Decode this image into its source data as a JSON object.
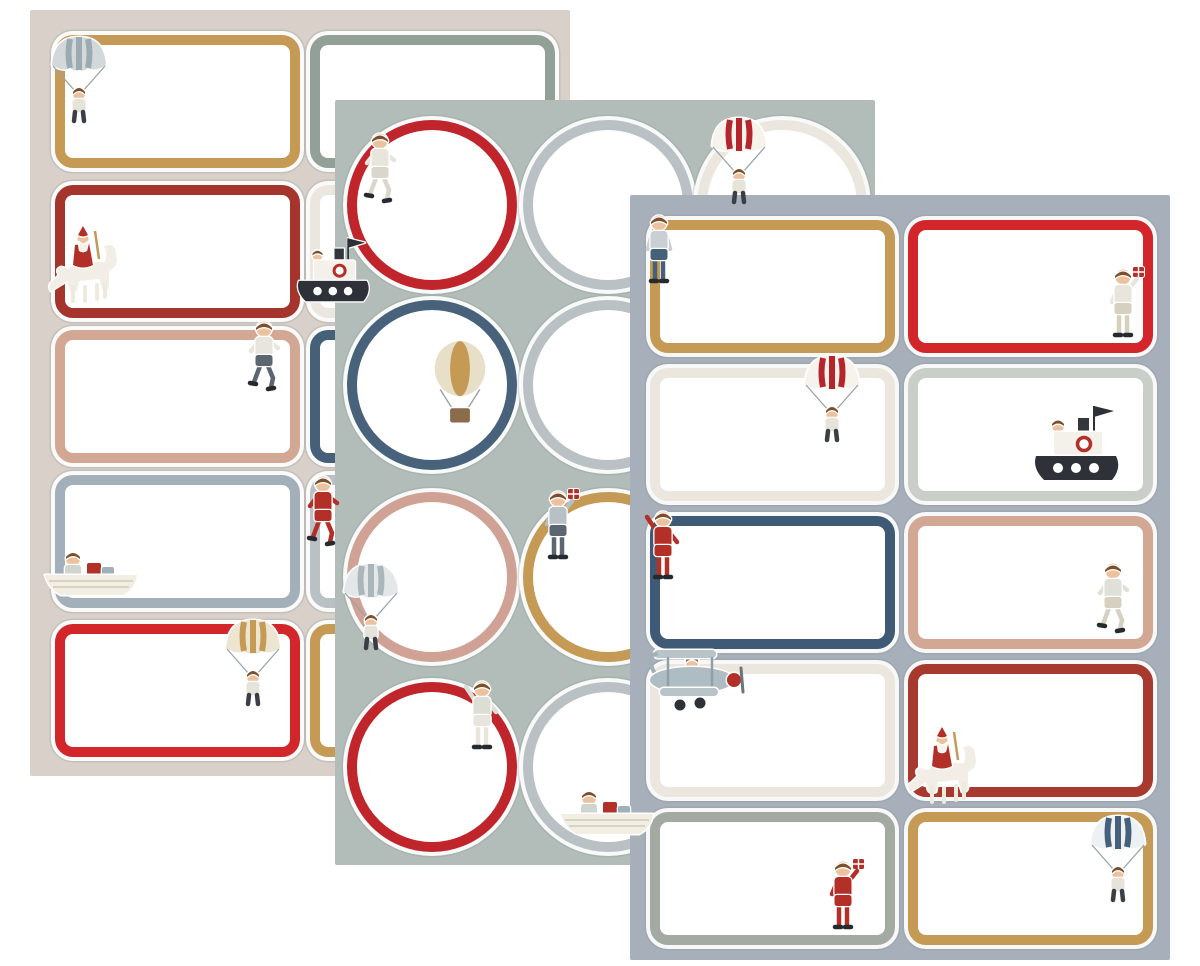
{
  "scene": {
    "background": "#ffffff",
    "palette": {
      "gold": "#c49a55",
      "bright_red": "#d2262b",
      "dark_red": "#a4342c",
      "dusty_pink": "#d2a794",
      "navy": "#46607a",
      "blue_grey": "#a3b0b9",
      "light_grey": "#bac1c4",
      "ivory": "#ece7de",
      "sage": "#93a098"
    }
  },
  "sheets": [
    {
      "id": "left",
      "bg": "#d8d0c9",
      "x": 30,
      "y": 10,
      "w": 540,
      "h": 766,
      "shape": "rect",
      "cell": {
        "w": 245,
        "h": 133
      },
      "col_x": [
        25,
        280
      ],
      "row_y": [
        25,
        175,
        320,
        465,
        614
      ],
      "labels": [
        {
          "row": 0,
          "col": 0,
          "border": "#c49a55",
          "icon": {
            "type": "parachute",
            "canopy": "#d3d9da",
            "stripe": "#9cabb2"
          },
          "ix": -8,
          "iy": -4
        },
        {
          "row": 1,
          "col": 0,
          "border": "#a4342c",
          "icon": {
            "type": "santa"
          },
          "ix": -10,
          "iy": 44
        },
        {
          "row": 2,
          "col": 0,
          "border": "#d2a794",
          "icon": {
            "type": "boy",
            "pose": "run",
            "shirt": "#e8e5dc",
            "pants": "#5b6670"
          },
          "ix": 186,
          "iy": -12
        },
        {
          "row": 3,
          "col": 0,
          "border": "#a3b0b9",
          "icon": {
            "type": "rowboat"
          },
          "ix": -12,
          "iy": 70
        },
        {
          "row": 4,
          "col": 0,
          "border": "#d2262b",
          "icon": {
            "type": "parachute",
            "canopy": "#ece5d2",
            "stripe": "#c49a55"
          },
          "ix": 166,
          "iy": -10
        },
        {
          "row": 0,
          "col": 1,
          "border": "#93a098"
        },
        {
          "row": 1,
          "col": 1,
          "border": "#ece7de",
          "icon": {
            "type": "steamboat"
          },
          "ix": -18,
          "iy": 50,
          "scale": 0.85
        },
        {
          "row": 2,
          "col": 1,
          "border": "#46607a"
        },
        {
          "row": 3,
          "col": 1,
          "border": "#bac1c4",
          "icon": {
            "type": "boy",
            "pose": "run",
            "shirt": "#b23028",
            "pants": "#b23028"
          },
          "ix": -10,
          "iy": -2
        },
        {
          "row": 4,
          "col": 1,
          "border": "#c49a55"
        }
      ]
    },
    {
      "id": "middle",
      "bg": "#b2bdb9",
      "x": 335,
      "y": 100,
      "w": 540,
      "h": 765,
      "shape": "circle",
      "cell": {
        "d": 170
      },
      "col_x": [
        12,
        188,
        362
      ],
      "row_y": [
        20,
        200,
        392,
        582
      ],
      "labels": [
        {
          "row": 0,
          "col": 0,
          "border": "#c1252c",
          "icon": {
            "type": "boy",
            "pose": "run",
            "shirt": "#e8e5dc",
            "pants": "#d9d6cc"
          },
          "ix": 10,
          "iy": 10
        },
        {
          "row": 0,
          "col": 1,
          "border": "#bac1c4"
        },
        {
          "row": 0,
          "col": 2,
          "border": "#ece7de",
          "icon": {
            "type": "parachute",
            "canopy": "#f6f2ec",
            "stripe": "#b5262c"
          },
          "ix": 10,
          "iy": -8
        },
        {
          "row": 1,
          "col": 0,
          "border": "#48627c",
          "icon": {
            "type": "balloon",
            "color": "#e7dfc8",
            "stripe": "#c49a55"
          },
          "ix": 80,
          "iy": 40,
          "scale": 1.1
        },
        {
          "row": 1,
          "col": 1,
          "border": "#bac1c4"
        },
        {
          "row": 1,
          "col": 2,
          "border": "#bac1c4"
        },
        {
          "row": 2,
          "col": 0,
          "border": "#d0a195",
          "icon": {
            "type": "parachute",
            "canopy": "#e3e7e8",
            "stripe": "#aab6bb"
          },
          "ix": -8,
          "iy": 66
        },
        {
          "row": 2,
          "col": 1,
          "border": "#c49a55",
          "icon": {
            "type": "boy",
            "pose": "gift",
            "shirt": "#b7c0c4",
            "pants": "#5b6670"
          },
          "ix": 12,
          "iy": -4
        },
        {
          "row": 2,
          "col": 2,
          "border": "#ece7de"
        },
        {
          "row": 3,
          "col": 0,
          "border": "#c1252c",
          "icon": {
            "type": "boy",
            "pose": "wave",
            "shirt": "#dcded6",
            "pants": "#e8e5dc"
          },
          "ix": 112,
          "iy": -4
        },
        {
          "row": 3,
          "col": 1,
          "border": "#bac1c4",
          "icon": {
            "type": "rowboat"
          },
          "ix": 36,
          "iy": 102
        },
        {
          "row": 3,
          "col": 2,
          "border": "#bac1c4"
        }
      ]
    },
    {
      "id": "right",
      "bg": "#a6afba",
      "x": 630,
      "y": 195,
      "w": 540,
      "h": 765,
      "shape": "rect",
      "cell": {
        "w": 245,
        "h": 133
      },
      "col_x": [
        20,
        278
      ],
      "row_y": [
        25,
        173,
        321,
        469,
        617
      ],
      "labels": [
        {
          "row": 0,
          "col": 0,
          "border": "#c49a55",
          "icon": {
            "type": "boy",
            "pose": "stand",
            "shirt": "#c9cfd2",
            "pants": "#46607a"
          },
          "ix": -14,
          "iy": -8
        },
        {
          "row": 0,
          "col": 1,
          "border": "#d2262b",
          "icon": {
            "type": "boy",
            "pose": "gift",
            "shirt": "#e8e5dc",
            "pants": "#d6d0c0"
          },
          "ix": 192,
          "iy": 46
        },
        {
          "row": 1,
          "col": 0,
          "border": "#ece7de",
          "icon": {
            "type": "parachute",
            "canopy": "#f6f2ec",
            "stripe": "#b5262c"
          },
          "ix": 150,
          "iy": -18
        },
        {
          "row": 1,
          "col": 1,
          "border": "#c9cec9",
          "icon": {
            "type": "steamboat"
          },
          "ix": 120,
          "iy": 34
        },
        {
          "row": 2,
          "col": 0,
          "border": "#3f5a76",
          "icon": {
            "type": "boy",
            "pose": "wave",
            "shirt": "#b23028",
            "pants": "#b23028"
          },
          "ix": -10,
          "iy": -8
        },
        {
          "row": 2,
          "col": 1,
          "border": "#d2a794",
          "icon": {
            "type": "boy",
            "pose": "run",
            "shirt": "#dfe0d8",
            "pants": "#d6d0c0"
          },
          "ix": 182,
          "iy": 44
        },
        {
          "row": 3,
          "col": 0,
          "border": "#ece7de",
          "icon": {
            "type": "biplane"
          },
          "ix": -16,
          "iy": -18
        },
        {
          "row": 3,
          "col": 1,
          "border": "#a8392e",
          "icon": {
            "type": "santa"
          },
          "ix": -4,
          "iy": 66
        },
        {
          "row": 4,
          "col": 0,
          "border": "#a2aaa2",
          "icon": {
            "type": "boy",
            "pose": "gift",
            "shirt": "#b23028",
            "pants": "#b23028"
          },
          "ix": 170,
          "iy": 46
        },
        {
          "row": 4,
          "col": 1,
          "border": "#c49a55",
          "icon": {
            "type": "parachute",
            "canopy": "#eef1f3",
            "stripe": "#46607c"
          },
          "ix": 178,
          "iy": -2
        }
      ]
    }
  ]
}
